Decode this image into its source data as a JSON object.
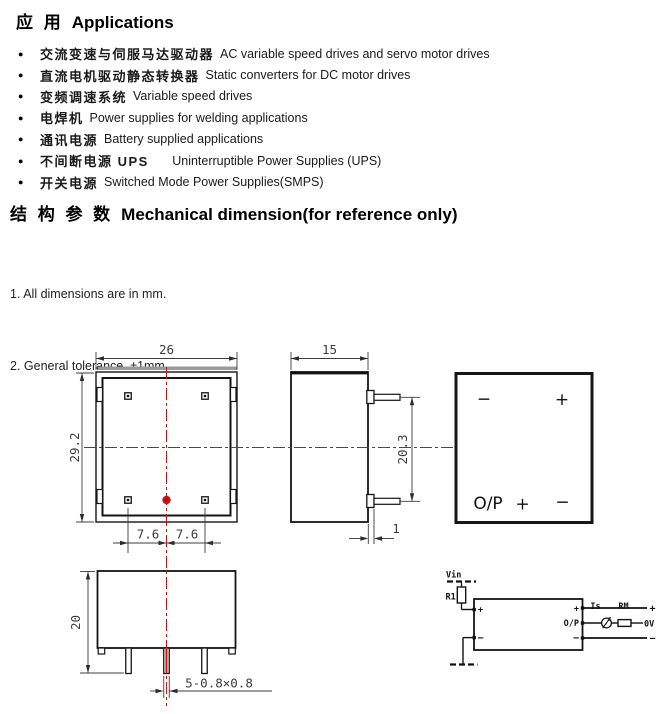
{
  "applications": {
    "title_zh": "应 用",
    "title_en": "Applications",
    "bullet": "●",
    "items": [
      {
        "zh": "交流变速与伺服马达驱动器",
        "en": "AC variable speed drives and servo motor drives"
      },
      {
        "zh": "直流电机驱动静态转换器",
        "en": "Static converters for DC motor drives"
      },
      {
        "zh": "变频调速系统",
        "en": "Variable speed drives"
      },
      {
        "zh": "电焊机",
        "en": "Power supplies for welding applications"
      },
      {
        "zh": "通讯电源",
        "en": "Battery supplied applications"
      },
      {
        "zh": "不间断电源 UPS",
        "en": "     Uninterruptible Power Supplies (UPS)"
      },
      {
        "zh": "开关电源",
        "en": "Switched Mode Power Supplies(SMPS)"
      }
    ]
  },
  "mechanical": {
    "title_zh": "结 构 参 数",
    "title_en": "Mechanical dimension(for reference only)",
    "notes": [
      "1. All dimensions are in mm.",
      "2. General tolerance  ±1mm."
    ]
  },
  "drawing": {
    "front_view": {
      "width": "26",
      "height": "29.2",
      "pin_pitch_left": "7.6",
      "pin_pitch_right": "7.6"
    },
    "side_view": {
      "depth": "15",
      "pin_span": "20.3",
      "pin_offset": "1"
    },
    "bottom_view": {
      "height": "20",
      "pin_size": "5-0.8×0.8"
    },
    "face_view": {
      "top_left": "−",
      "top_right": "+",
      "bottom_left": "O/P",
      "bottom_center": "+",
      "bottom_right": "−"
    },
    "schematic": {
      "vin": "Vin",
      "r1": "R1",
      "is_label": "Is",
      "rm_label": "RM",
      "zero_v": "0V",
      "op": "O/P",
      "plus": "+",
      "minus": "−"
    },
    "colors": {
      "centerline_red": "#cc1111",
      "line_black": "#151515"
    }
  }
}
